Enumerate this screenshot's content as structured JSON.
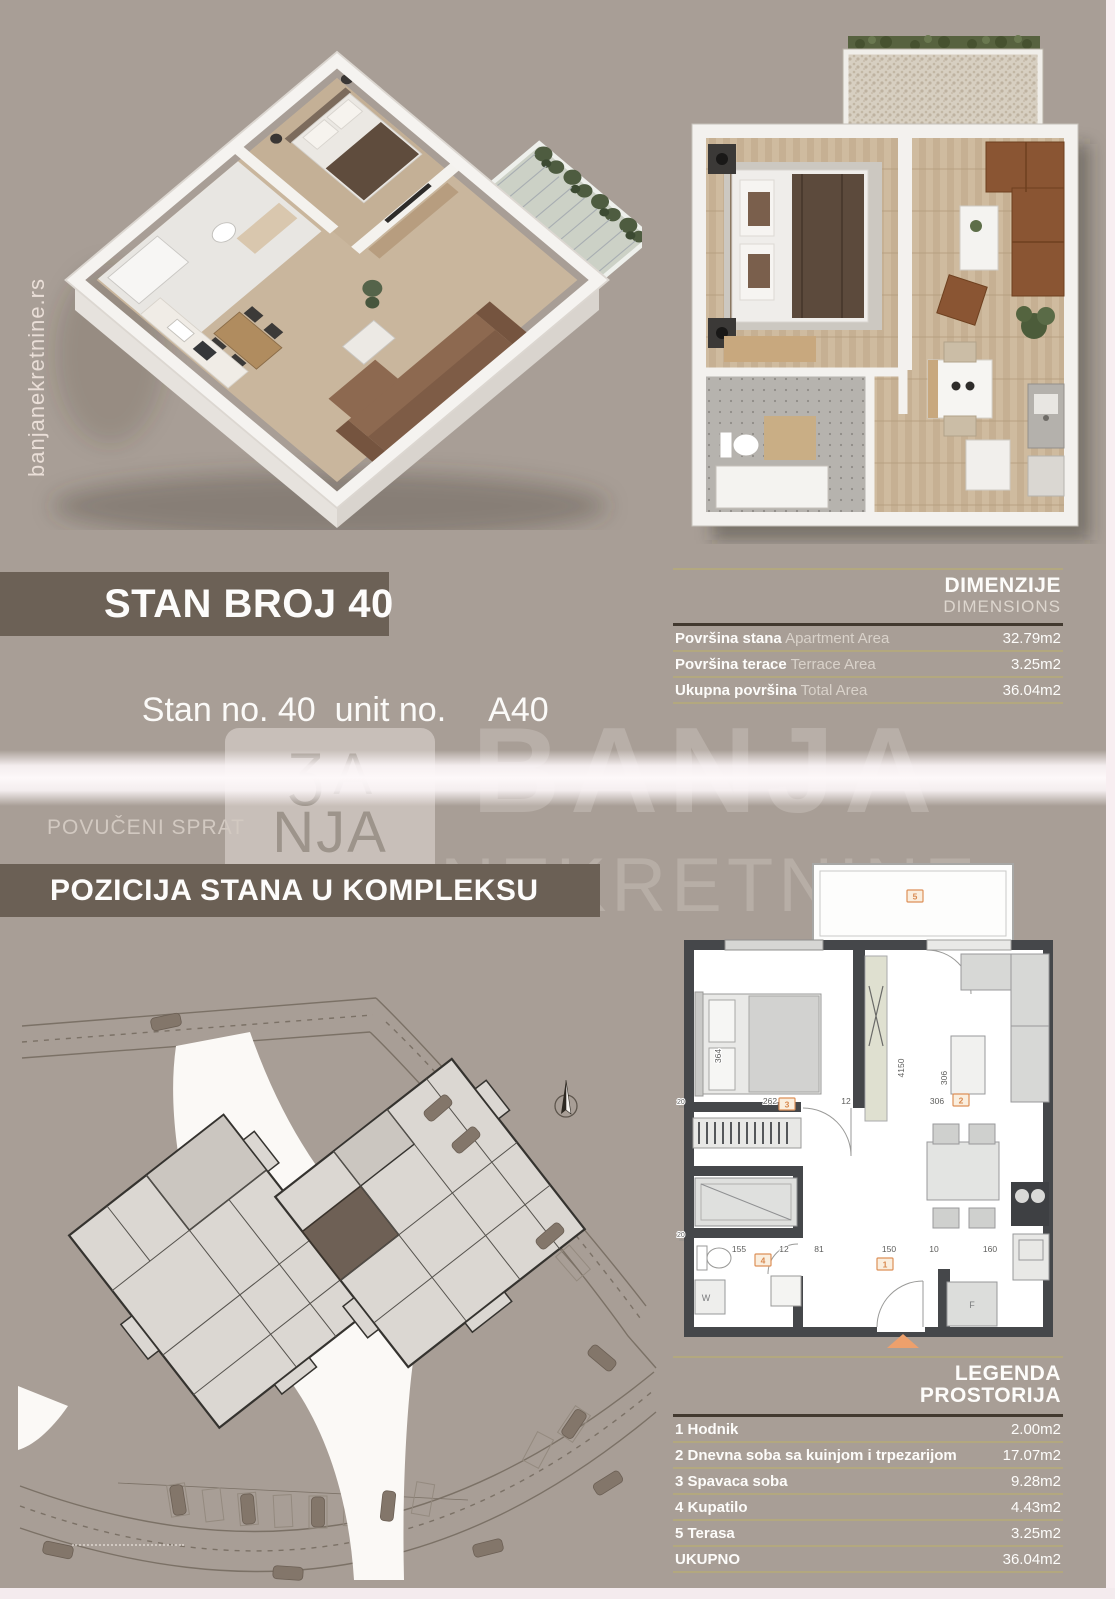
{
  "page": {
    "site_url_vertical": "banjanekretnine.rs",
    "unit_title": "STAN BROJ 40",
    "unit_subtitle_label": "Stan no. 40  unit no.",
    "unit_code": "A40",
    "floor_label": "POVUČENI SPRAT",
    "position_heading": "POZICIJA STANA U KOMPLEKSU"
  },
  "watermark": {
    "line1": "BANJA",
    "line2": "NEKRETNINE",
    "logo_top": "ƷA",
    "logo_bottom": "NJA"
  },
  "dimensions_table": {
    "title_sr": "DIMENZIJE",
    "title_en": "DIMENSIONS",
    "rows": [
      {
        "label_sr": "Površina stana",
        "label_en": "Apartment Area",
        "value": "32.79m2"
      },
      {
        "label_sr": "Površina terace",
        "label_en": "Terrace Area",
        "value": "3.25m2"
      },
      {
        "label_sr": "Ukupna površina",
        "label_en": "Total Area",
        "value": "36.04m2"
      }
    ]
  },
  "legend_table": {
    "title_line1": "LEGENDA",
    "title_line2": "PROSTORIJA",
    "rows": [
      {
        "label": "1 Hodnik",
        "value": "2.00m2"
      },
      {
        "label": "2 Dnevna soba sa kuinjom i trpezarijom",
        "value": "17.07m2"
      },
      {
        "label": "3 Spavaca soba",
        "value": "9.28m2"
      },
      {
        "label": "4 Kupatilo",
        "value": "4.43m2"
      },
      {
        "label": "5 Terasa",
        "value": "3.25m2"
      },
      {
        "label": "UKUPNO",
        "value": "36.04m2"
      }
    ]
  },
  "floorplan": {
    "room_markers": {
      "hall": "1",
      "living": "2",
      "bedroom": "3",
      "bathroom": "4",
      "terrace": "5"
    },
    "dims_top": [
      "262",
      "12",
      "306"
    ],
    "dims_bottom": [
      "155",
      "12",
      "81",
      "150",
      "10",
      "160"
    ],
    "dims_vertical": [
      "364",
      "4150",
      "306"
    ],
    "margin_dims": [
      "20",
      "20"
    ],
    "appliance_labels": {
      "washer": "W",
      "fridge": "F"
    }
  },
  "colors": {
    "background": "#a89e96",
    "bar_brown": "#6c6156",
    "separator_khaki": "#b3a87f",
    "separator_dark": "#42392f",
    "accent_orange": "#dd9058",
    "plan_wall": "#45474a",
    "highlight_unit": "#6e6055"
  }
}
